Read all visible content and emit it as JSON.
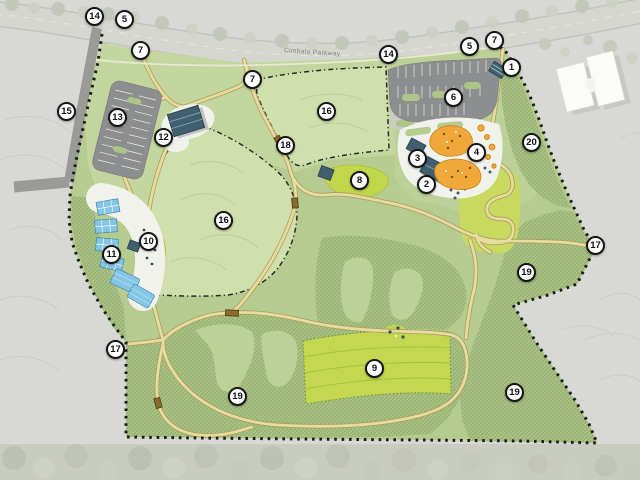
{
  "map": {
    "road_label": "Cimbala Parkway",
    "markers": [
      {
        "n": "14",
        "x": 95,
        "y": 17
      },
      {
        "n": "5",
        "x": 125,
        "y": 20
      },
      {
        "n": "7",
        "x": 141,
        "y": 51
      },
      {
        "n": "7",
        "x": 253,
        "y": 80
      },
      {
        "n": "14",
        "x": 389,
        "y": 55
      },
      {
        "n": "5",
        "x": 470,
        "y": 47
      },
      {
        "n": "7",
        "x": 495,
        "y": 41
      },
      {
        "n": "1",
        "x": 512,
        "y": 68
      },
      {
        "n": "6",
        "x": 454,
        "y": 98
      },
      {
        "n": "16",
        "x": 327,
        "y": 112
      },
      {
        "n": "20",
        "x": 532,
        "y": 143
      },
      {
        "n": "3",
        "x": 418,
        "y": 159
      },
      {
        "n": "4",
        "x": 477,
        "y": 153
      },
      {
        "n": "2",
        "x": 427,
        "y": 185
      },
      {
        "n": "8",
        "x": 360,
        "y": 181
      },
      {
        "n": "18",
        "x": 286,
        "y": 146
      },
      {
        "n": "15",
        "x": 67,
        "y": 112
      },
      {
        "n": "13",
        "x": 118,
        "y": 118
      },
      {
        "n": "12",
        "x": 164,
        "y": 138
      },
      {
        "n": "16",
        "x": 224,
        "y": 221
      },
      {
        "n": "10",
        "x": 149,
        "y": 242
      },
      {
        "n": "11",
        "x": 112,
        "y": 255
      },
      {
        "n": "17",
        "x": 116,
        "y": 350
      },
      {
        "n": "19",
        "x": 238,
        "y": 397
      },
      {
        "n": "9",
        "x": 375,
        "y": 369
      },
      {
        "n": "19",
        "x": 515,
        "y": 393
      },
      {
        "n": "19",
        "x": 527,
        "y": 273
      },
      {
        "n": "17",
        "x": 596,
        "y": 246
      }
    ],
    "colors": {
      "outside": "#d8d8d4",
      "lawn": "#b5cb8f",
      "lawn_light": "#c4d69e",
      "meadow": "#d0e0ad",
      "hatch": "#a8c184",
      "field": "#c3d751",
      "chartreuse": "#c2d64b",
      "path": "#e8db9e",
      "path_edge": "#a99b5e",
      "parking": "#8d8e8f",
      "road": "#9a9a96",
      "parkway": "#d6d6d1",
      "building": "#40606f",
      "water": "#85c6e6",
      "playground": "#f0a83a",
      "plaza": "#f2f2ed",
      "boundary": "#1b1b1b"
    }
  }
}
